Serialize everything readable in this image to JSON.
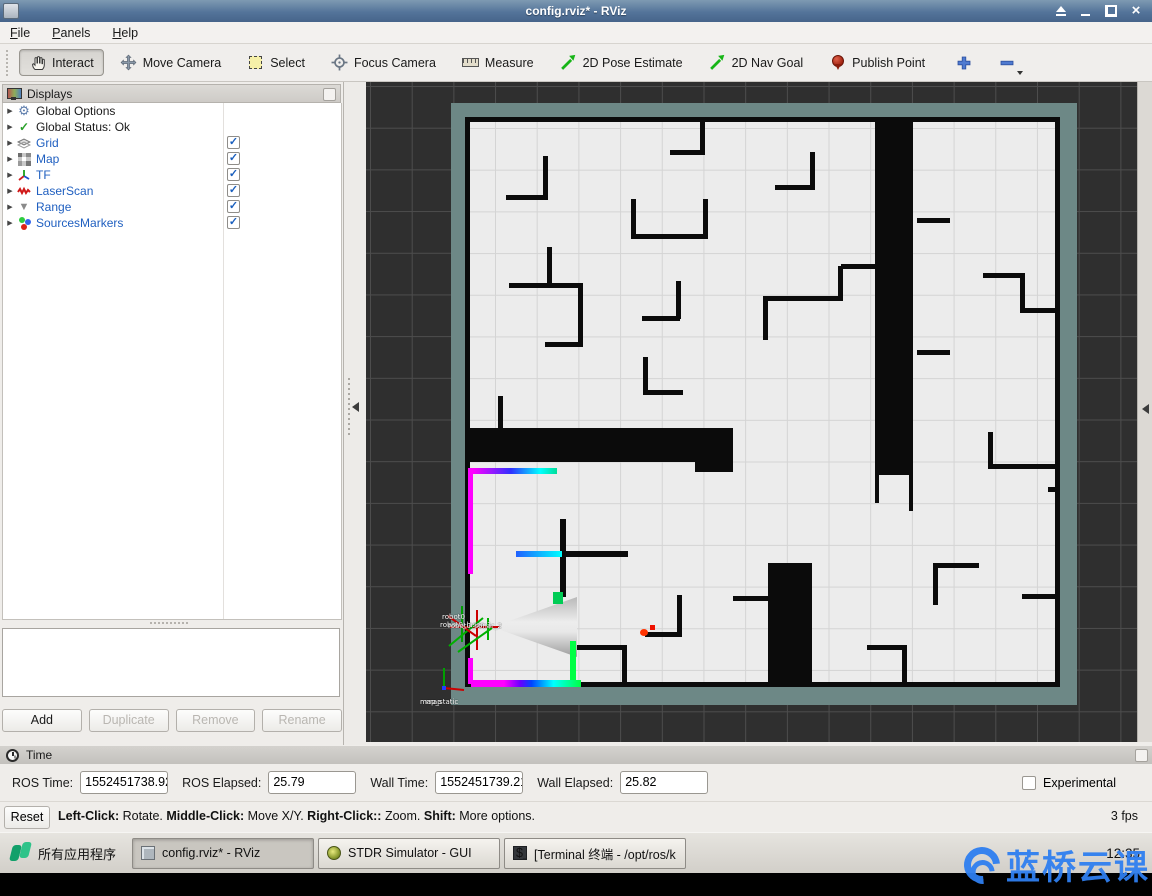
{
  "window": {
    "title": "config.rviz* - RViz"
  },
  "menu": {
    "items": [
      "File",
      "Panels",
      "Help"
    ]
  },
  "toolbar": {
    "tools": [
      {
        "label": "Interact",
        "icon": "hand-icon",
        "active": true
      },
      {
        "label": "Move Camera",
        "icon": "move-icon",
        "active": false
      },
      {
        "label": "Select",
        "icon": "select-icon",
        "active": false
      },
      {
        "label": "Focus Camera",
        "icon": "focus-icon",
        "active": false
      },
      {
        "label": "Measure",
        "icon": "measure-icon",
        "active": false
      },
      {
        "label": "2D Pose Estimate",
        "icon": "green-arrow-icon",
        "active": false
      },
      {
        "label": "2D Nav Goal",
        "icon": "green-arrow-icon",
        "active": false
      },
      {
        "label": "Publish Point",
        "icon": "pin-icon",
        "active": false
      }
    ],
    "add_tool": "plus-icon",
    "remove_tool": "minus-icon"
  },
  "displays_panel": {
    "title": "Displays",
    "items": [
      {
        "label": "Global Options",
        "icon": "gear-icon",
        "color": "#1a1a1a",
        "checked": null
      },
      {
        "label": "Global Status: Ok",
        "icon": "check-icon",
        "color": "#1a1a1a",
        "checked": null
      },
      {
        "label": "Grid",
        "icon": "grid-icon",
        "color": "#1f5fc0",
        "checked": true
      },
      {
        "label": "Map",
        "icon": "map-icon",
        "color": "#1f5fc0",
        "checked": true
      },
      {
        "label": "TF",
        "icon": "tf-icon",
        "color": "#1f5fc0",
        "checked": true
      },
      {
        "label": "LaserScan",
        "icon": "laser-icon",
        "color": "#1f5fc0",
        "checked": true
      },
      {
        "label": "Range",
        "icon": "range-icon",
        "color": "#1f5fc0",
        "checked": true
      },
      {
        "label": "SourcesMarkers",
        "icon": "markers-icon",
        "color": "#1f5fc0",
        "checked": true
      }
    ],
    "buttons": [
      {
        "label": "Add",
        "enabled": true
      },
      {
        "label": "Duplicate",
        "enabled": false
      },
      {
        "label": "Remove",
        "enabled": false
      },
      {
        "label": "Rename",
        "enabled": false
      }
    ]
  },
  "viewport": {
    "colors": {
      "background": "#2f2f2f",
      "map_margin": "#6d8886",
      "map_floor": "#ececec",
      "wall": "#0b0b0b",
      "laser_magenta": "#ff00ff",
      "laser_green": "#00ff44",
      "marker_red": "#ff3300"
    },
    "tf_labels": {
      "robot": [
        "robot0",
        "robot0_laser_1",
        "robot0_sonar_2"
      ],
      "map": [
        "map",
        "map_static"
      ]
    },
    "walls": [
      [
        177,
        74,
        5,
        44
      ],
      [
        140,
        113,
        42,
        5
      ],
      [
        334,
        37,
        5,
        36
      ],
      [
        304,
        68,
        34,
        5
      ],
      [
        265,
        117,
        5,
        40
      ],
      [
        337,
        117,
        5,
        40
      ],
      [
        265,
        152,
        77,
        5
      ],
      [
        444,
        70,
        5,
        38
      ],
      [
        409,
        103,
        40,
        5
      ],
      [
        509,
        35,
        38,
        358
      ],
      [
        509,
        393,
        4,
        28
      ],
      [
        543,
        393,
        4,
        36
      ],
      [
        551,
        136,
        33,
        5
      ],
      [
        551,
        268,
        33,
        5
      ],
      [
        617,
        191,
        42,
        5
      ],
      [
        654,
        191,
        5,
        40
      ],
      [
        654,
        226,
        40,
        5
      ],
      [
        397,
        214,
        80,
        5
      ],
      [
        397,
        216,
        5,
        42
      ],
      [
        472,
        184,
        5,
        35
      ],
      [
        475,
        182,
        34,
        5
      ],
      [
        181,
        165,
        5,
        40
      ],
      [
        143,
        201,
        74,
        5
      ],
      [
        212,
        203,
        5,
        62
      ],
      [
        179,
        260,
        38,
        5
      ],
      [
        276,
        234,
        38,
        5
      ],
      [
        310,
        199,
        5,
        38
      ],
      [
        277,
        275,
        5,
        38
      ],
      [
        277,
        308,
        40,
        5
      ],
      [
        194,
        437,
        6,
        78
      ],
      [
        150,
        469,
        112,
        6
      ],
      [
        311,
        513,
        5,
        42
      ],
      [
        279,
        550,
        37,
        5
      ],
      [
        402,
        481,
        44,
        124
      ],
      [
        367,
        514,
        36,
        5
      ],
      [
        101,
        346,
        266,
        34
      ],
      [
        329,
        346,
        38,
        44
      ],
      [
        132,
        314,
        5,
        32
      ],
      [
        209,
        563,
        52,
        5
      ],
      [
        256,
        563,
        5,
        42
      ],
      [
        622,
        350,
        5,
        37
      ],
      [
        622,
        382,
        70,
        5
      ],
      [
        567,
        481,
        5,
        42
      ],
      [
        567,
        481,
        46,
        5
      ],
      [
        656,
        512,
        38,
        5
      ],
      [
        501,
        563,
        40,
        5
      ],
      [
        536,
        563,
        5,
        42
      ],
      [
        682,
        405,
        12,
        5
      ]
    ],
    "lasers": [
      {
        "x": 102,
        "y": 386,
        "w": 5,
        "h": 106,
        "bg": "#ff00ff"
      },
      {
        "x": 102,
        "y": 576,
        "w": 5,
        "h": 26,
        "bg": "#ff00ff"
      },
      {
        "x": 107,
        "y": 386,
        "w": 84,
        "h": 6,
        "bg": "linear-gradient(90deg,#ff00ff,#3030ff 45%,#00ffff 80%,#00dd99)"
      },
      {
        "x": 150,
        "y": 469,
        "w": 46,
        "h": 6,
        "bg": "linear-gradient(90deg,#2060ff,#00ffff)"
      },
      {
        "x": 187,
        "y": 510,
        "w": 10,
        "h": 12,
        "bg": "#00cc55"
      },
      {
        "x": 204,
        "y": 559,
        "w": 6,
        "h": 46,
        "bg": "#00ff44"
      },
      {
        "x": 105,
        "y": 598,
        "w": 110,
        "h": 7,
        "bg": "linear-gradient(90deg,#ff00ff 30%,#6600ff 45%,#0044ff 55%,#00ffff 75%,#00ff44)"
      },
      {
        "x": 274,
        "y": 547,
        "w": 8,
        "h": 7,
        "bg": "#ff3300",
        "round": true
      },
      {
        "x": 284,
        "y": 543,
        "w": 5,
        "h": 5,
        "bg": "#ee1100"
      }
    ]
  },
  "time_panel": {
    "title": "Time",
    "fields": [
      {
        "label": "ROS Time:",
        "value": "1552451738.92"
      },
      {
        "label": "ROS Elapsed:",
        "value": "25.79"
      },
      {
        "label": "Wall Time:",
        "value": "1552451739.21"
      },
      {
        "label": "Wall Elapsed:",
        "value": "25.82"
      }
    ],
    "experimental_label": "Experimental",
    "reset_label": "Reset",
    "status": [
      {
        "b": "Left-Click:",
        "t": " Rotate. "
      },
      {
        "b": "Middle-Click:",
        "t": " Move X/Y. "
      },
      {
        "b": "Right-Click::",
        "t": " Zoom. "
      },
      {
        "b": "Shift:",
        "t": " More options."
      }
    ],
    "fps": "3 fps"
  },
  "taskbar": {
    "app_menu_label": "所有应用程序",
    "tasks": [
      {
        "label": "config.rviz* - RViz",
        "icon": "rviz-icon",
        "active": true
      },
      {
        "label": "STDR Simulator - GUI",
        "icon": "stdr-icon",
        "active": false
      },
      {
        "label": "[Terminal 终端 - /opt/ros/k…",
        "icon": "terminal-icon",
        "active": false
      }
    ],
    "clock": "12:35"
  },
  "watermark": {
    "text": "蓝桥云课",
    "color": "#2f7ff0"
  }
}
